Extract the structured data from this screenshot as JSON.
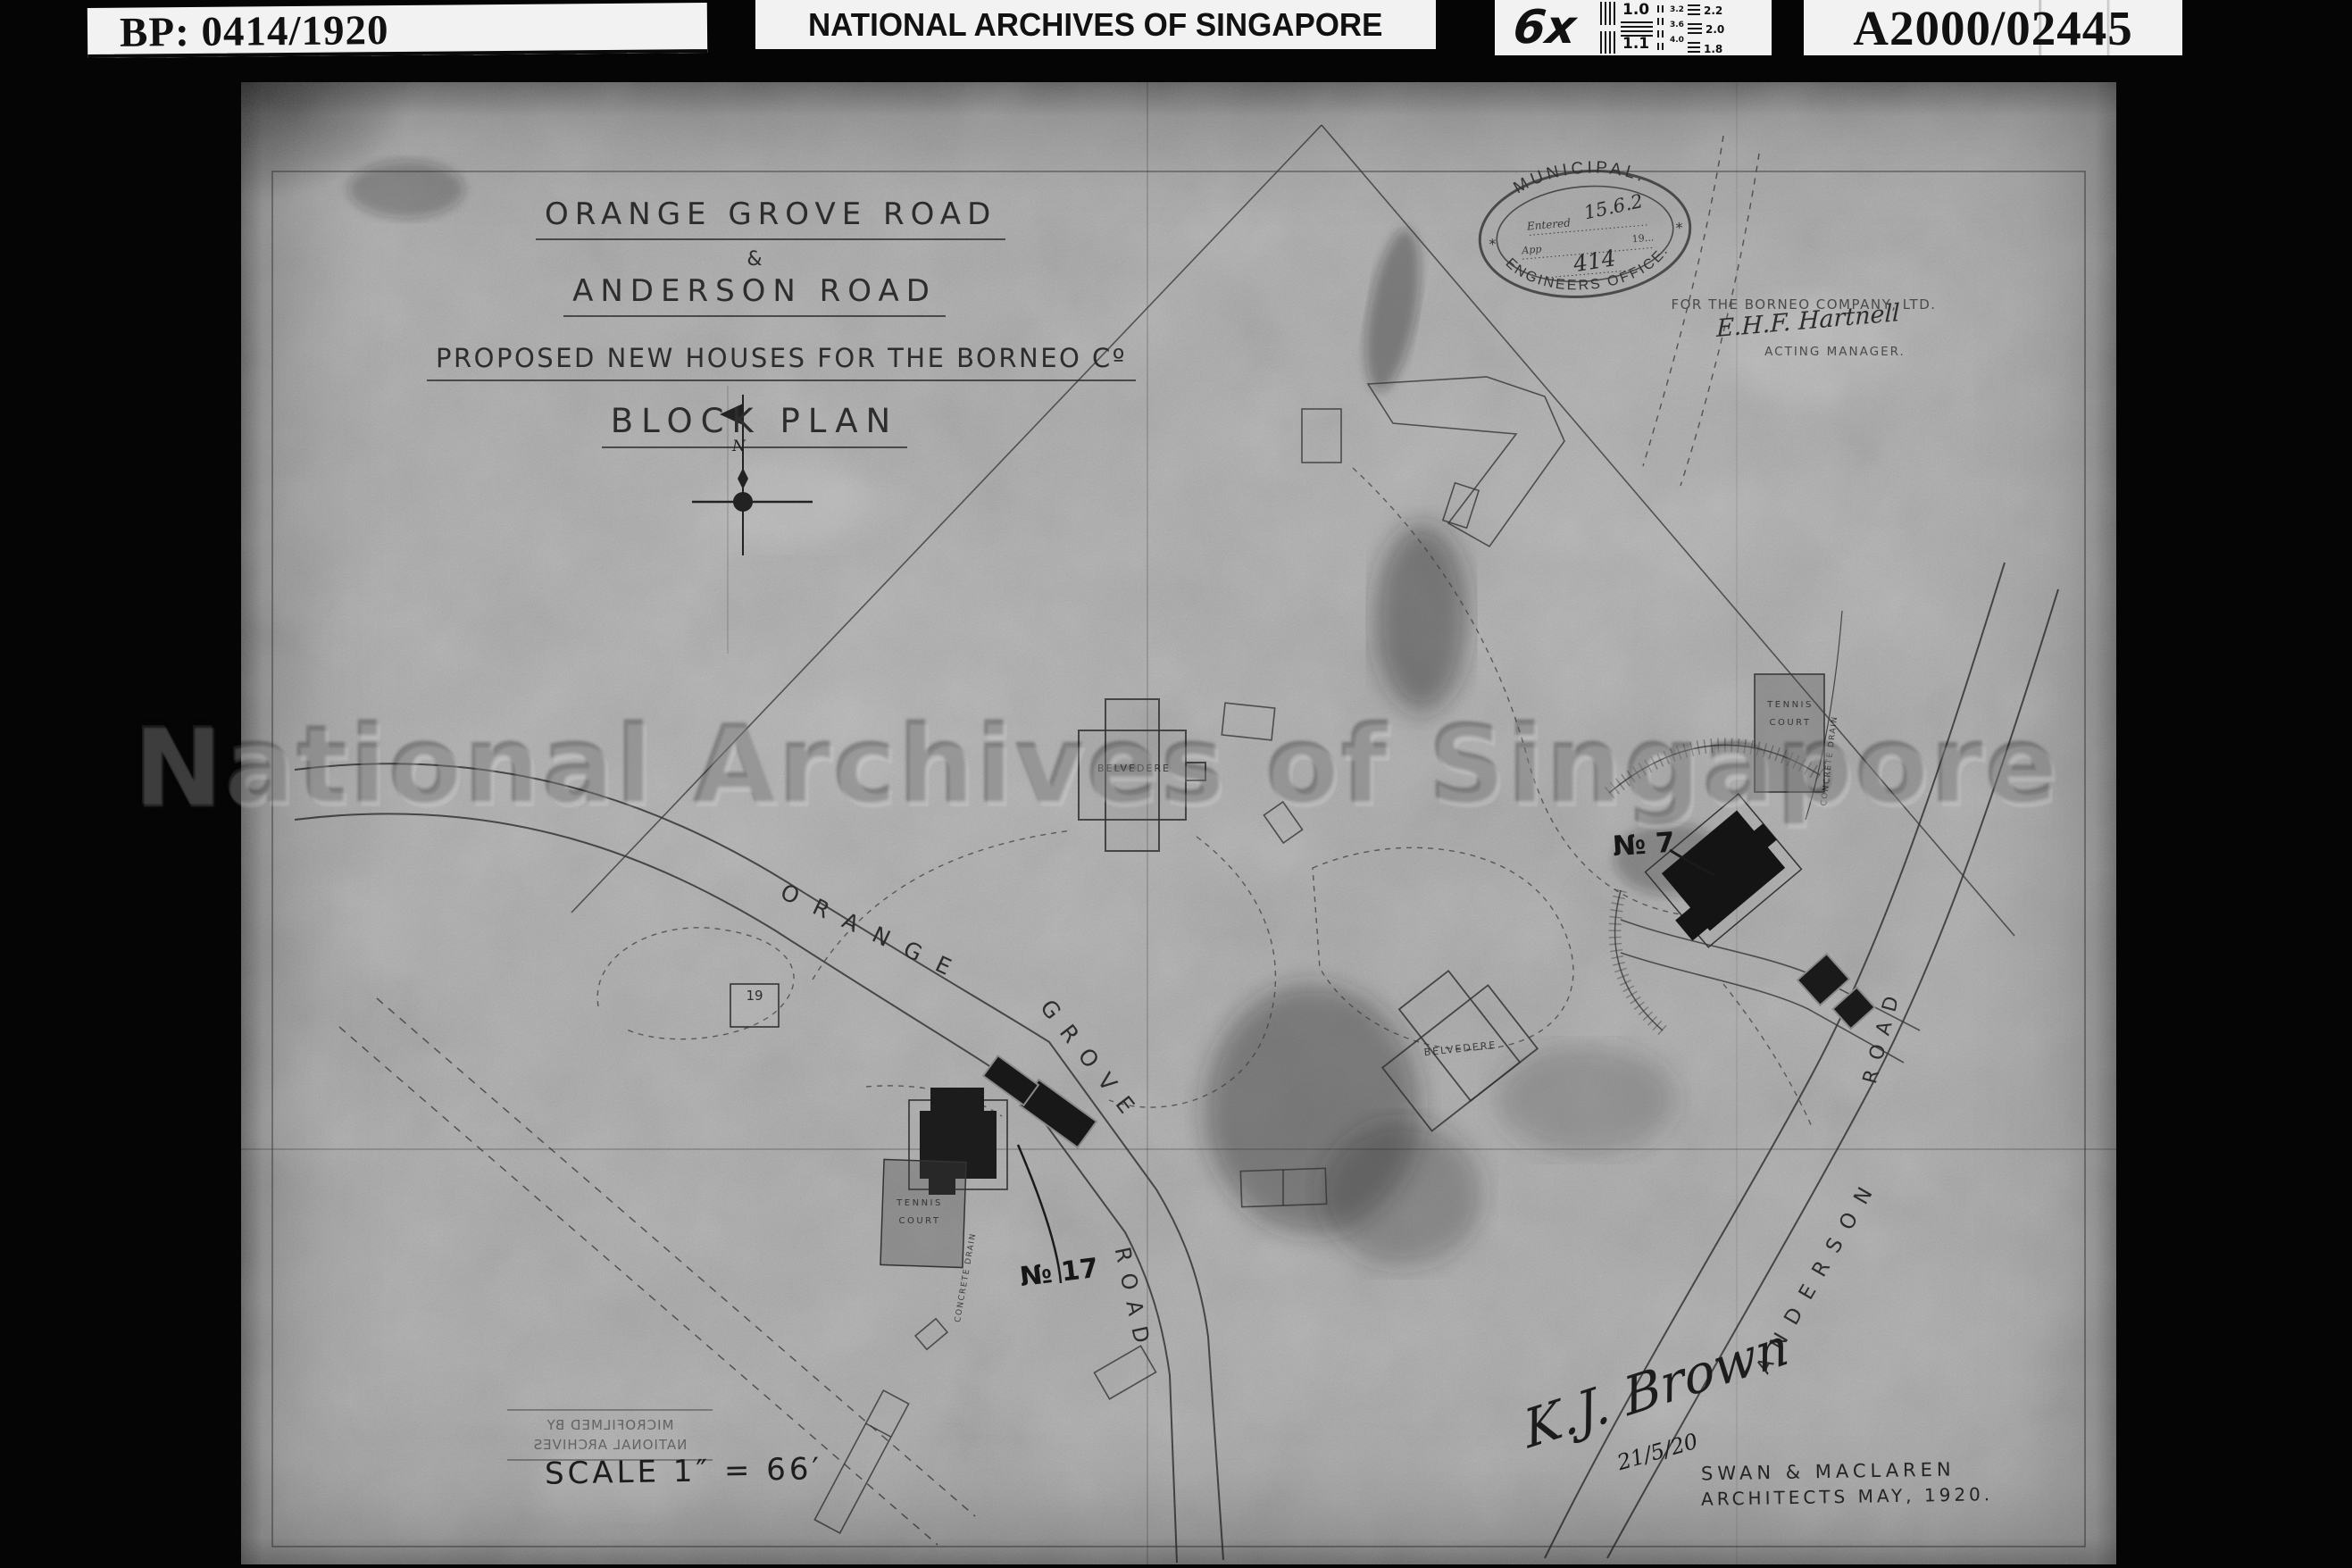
{
  "header": {
    "bp_number": "BP: 0414/1920",
    "archive_name": "NATIONAL ARCHIVES OF SINGAPORE",
    "magnification": "6x",
    "reference_number": "A2000/02445",
    "test_chart": {
      "left": [
        "1.0",
        "1.1"
      ],
      "mid": [
        "3.2",
        "3.6",
        "4.0"
      ],
      "right": [
        "2.2",
        "2.0",
        "1.8"
      ]
    }
  },
  "map": {
    "title": {
      "line1": "ORANGE GROVE ROAD",
      "line2": "&",
      "line3": "ANDERSON ROAD",
      "line4": "PROPOSED NEW HOUSES FOR THE BORNEO Cº",
      "line5": "BLOCK PLAN"
    },
    "stamp": {
      "arc_top": "MUNICIPAL.",
      "arc_bottom": "ENGINEERS OFFICE.",
      "entered_label": "Entered",
      "entered_value": "15.6.2",
      "approved_label": "App",
      "year_label": "19...",
      "number": "414",
      "asterisk": "*"
    },
    "borneo": {
      "company": "FOR THE BORNEO COMPANY, LTD.",
      "signature": "E.H.F. Hartnell",
      "role": "ACTING MANAGER."
    },
    "compass": "N",
    "watermark": "National Archives of Singapore",
    "roads": {
      "orange": "ORANGE",
      "grove": "GROVE",
      "road_lower": "ROAD",
      "anderson": "ANDERSON",
      "road_upper": "ROAD"
    },
    "labels": {
      "belvedere_west": "BELVEDERE",
      "belvedere_east": "BELVEDERE",
      "tennis_line1": "TENNIS",
      "tennis_line2": "COURT",
      "no7": "№ 7",
      "no17": "№ 17",
      "house19": "19",
      "concrete_drain": "CONCRETE DRAIN"
    },
    "microfilm": {
      "line1": "MICROFILMED BY",
      "line2": "NATIONAL ARCHIVES"
    },
    "scale": "SCALE 1″ = 66′",
    "architects": {
      "line1": "SWAN & MACLAREN",
      "line2": "ARCHITECTS MAY, 1920."
    },
    "approval": {
      "signature": "K.J. Brown",
      "date": "21/5/20"
    }
  }
}
